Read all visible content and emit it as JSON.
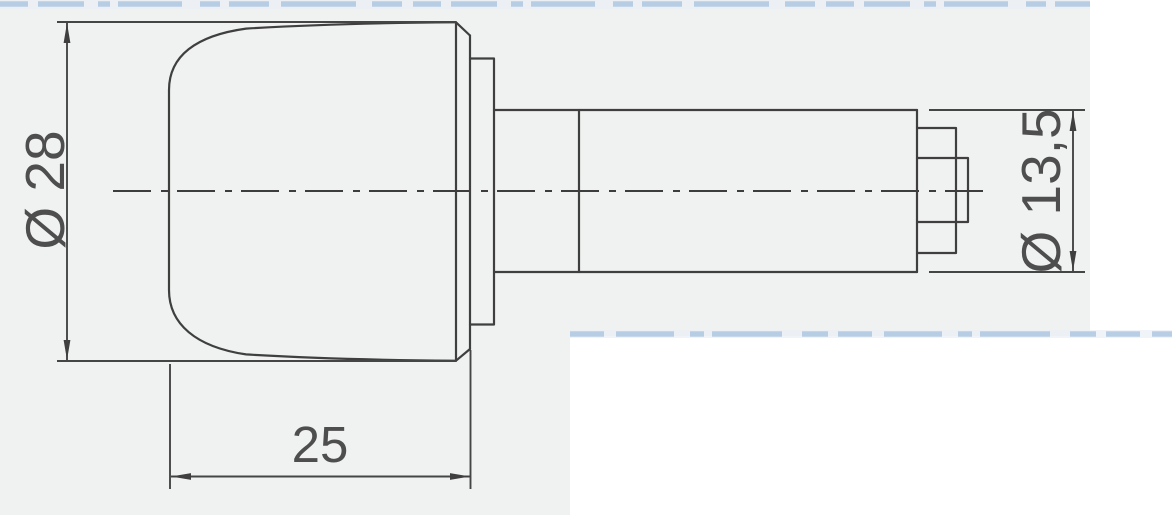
{
  "page": {
    "kind_label": "scanned technical drawing",
    "colors": {
      "paper": "#f0f2f1",
      "white_margin": "#ffffff",
      "line": "#3f3f3f",
      "text": "#4e4e4e",
      "scan_blue": "#a6c2dd"
    }
  },
  "drawing": {
    "view": "side-profile",
    "dimensions": {
      "cap_diameter": {
        "label": "Ø 28",
        "orientation": "vertical-rotated"
      },
      "shaft_diameter": {
        "label": "Ø 13,5",
        "orientation": "vertical-rotated"
      },
      "cap_length": {
        "label": "25",
        "orientation": "horizontal"
      }
    }
  }
}
